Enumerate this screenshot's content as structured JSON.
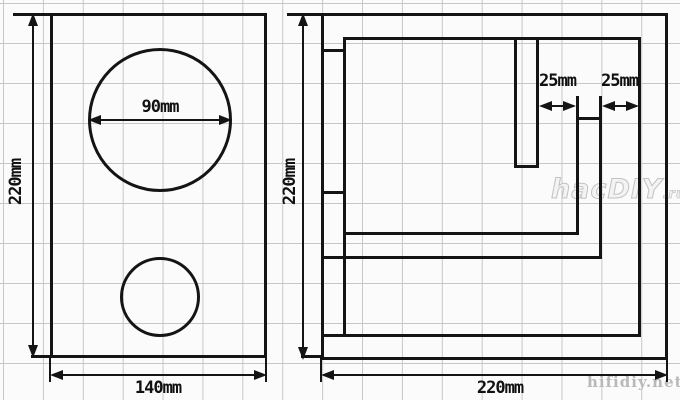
{
  "colors": {
    "line": "#141414",
    "grid": "#c7c7c7",
    "background": "#fbfbfb",
    "watermark": "#c2c2c2"
  },
  "watermark": {
    "logo_main": "hacDIY",
    "logo_suffix": ".ru",
    "site": "hifidiy.net"
  },
  "front_view": {
    "height_label": "220mm",
    "width_label": "140mm",
    "driver_diameter_label": "90mm"
  },
  "section_view": {
    "height_label": "220mm",
    "width_label": "220mm",
    "gap_labels": [
      "25mm",
      "25mm"
    ]
  }
}
